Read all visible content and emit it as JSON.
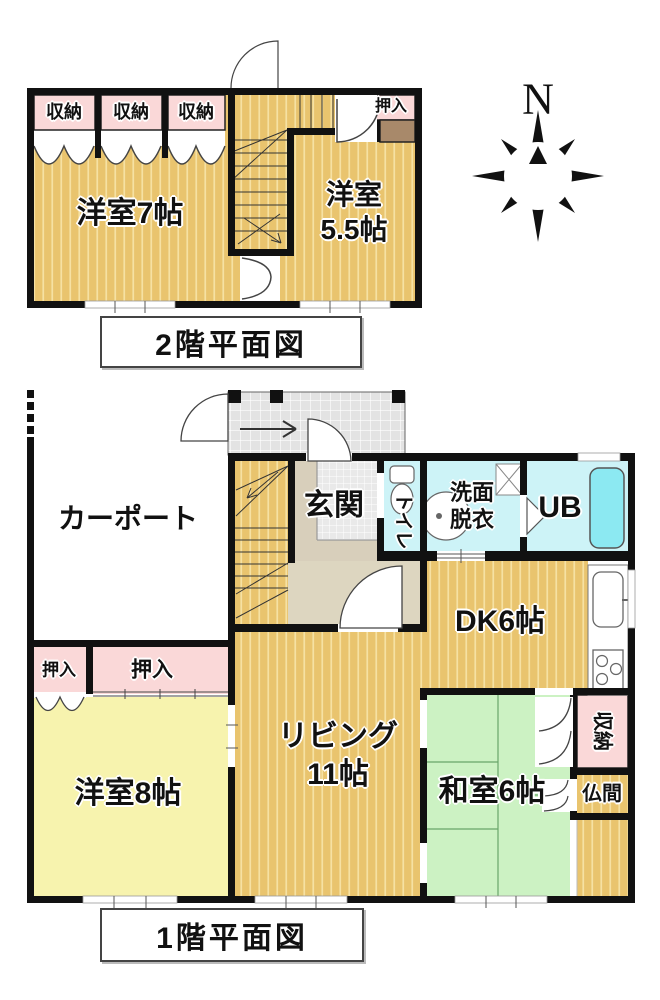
{
  "floor2": {
    "caption": "2階平面図",
    "closet_a": "収納",
    "closet_b": "収納",
    "closet_c": "収納",
    "room7": "洋室7帖",
    "room55_l1": "洋室",
    "room55_l2": "5.5帖",
    "oshiire": "押入"
  },
  "floor1": {
    "caption": "1階平面図",
    "carport": "カーポート",
    "genkan": "玄関",
    "toilet": "トイレ",
    "washroom_l1": "洗面",
    "washroom_l2": "脱衣",
    "unit_bath": "UB",
    "dk": "DK6帖",
    "living_l1": "リビング",
    "living_l2": "11帖",
    "oshiire_small": "押入",
    "oshiire_wide": "押入",
    "room8": "洋室8帖",
    "washitsu": "和室6帖",
    "storage": "収納",
    "butsuma": "仏間"
  },
  "compass": {
    "north": "N"
  },
  "colors": {
    "wall": "#111111",
    "wood_floor": "#e9c46e",
    "wood_stripe": "#f6e1a3",
    "tatami_green": "#ccf2c3",
    "closet_pink": "#fad8d8",
    "water_cyan": "#cdf3f7",
    "bath_tub": "#8ce9f2",
    "room_yellow": "#f7f3ae",
    "tile_gray": "#e3e3e3",
    "genkan_beige": "#d8cfbb",
    "hall_beige": "#ddd6c0",
    "closet_brown": "#a8896a"
  }
}
